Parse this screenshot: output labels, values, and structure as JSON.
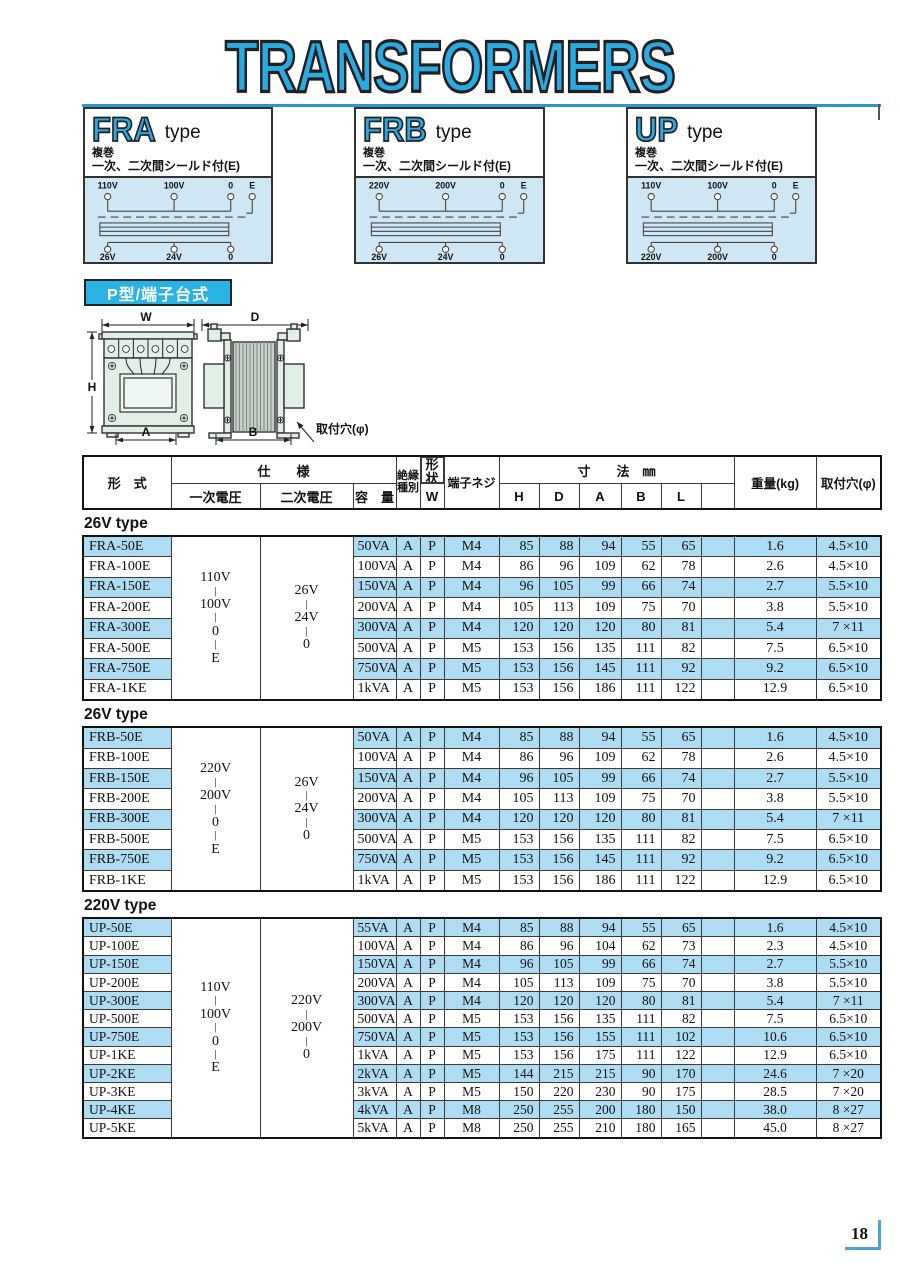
{
  "page": {
    "title": "TRANSFORMERS",
    "page_number": "18"
  },
  "colors": {
    "accent_blue": "#29abe2",
    "row_blue": "#aedcf2",
    "diagram_bg": "#cfe6f4",
    "badge_bg": "#29b2e5",
    "rule_blue": "#2b96d1",
    "corner_blue": "#4da3d8",
    "drawing_mint": "#e2efe6"
  },
  "type_boxes": [
    {
      "name": "FRA",
      "suffix": "type",
      "desc_line1": "複巻",
      "desc_line2": "一次、二次間シールド付(E)",
      "top_terminals": [
        "110V",
        "100V",
        "0",
        "E"
      ],
      "bottom_terminals": [
        "26V",
        "24V",
        "0"
      ]
    },
    {
      "name": "FRB",
      "suffix": "type",
      "desc_line1": "複巻",
      "desc_line2": "一次、二次間シールド付(E)",
      "top_terminals": [
        "220V",
        "200V",
        "0",
        "E"
      ],
      "bottom_terminals": [
        "26V",
        "24V",
        "0"
      ]
    },
    {
      "name": "UP",
      "suffix": "type",
      "desc_line1": "複巻",
      "desc_line2": "一次、二次間シールド付(E)",
      "top_terminals": [
        "110V",
        "100V",
        "0",
        "E"
      ],
      "bottom_terminals": [
        "220V",
        "200V",
        "0"
      ]
    }
  ],
  "shape_badge": "P型/端子台式",
  "dim": {
    "w": "W",
    "d": "D",
    "h": "H",
    "a": "A",
    "b": "B",
    "hole_label": "取付穴(φ)"
  },
  "table_header": {
    "model": "形　式",
    "spec": "仕　　様",
    "primary": "一次電圧",
    "secondary": "二次電圧",
    "capacity": "容　量",
    "insulation_l1": "絶縁",
    "insulation_l2": "種別",
    "shape": "形状",
    "screw": "端子ネジ",
    "dims": "寸　　法　㎜",
    "dim_cols": [
      "W",
      "H",
      "D",
      "A",
      "B",
      "L"
    ],
    "weight": "重量(kg)",
    "hole": "取付穴(φ)"
  },
  "sections": [
    {
      "title": "26V type",
      "primary": [
        "110V",
        "|",
        "100V",
        "|",
        "0",
        "|",
        "E"
      ],
      "secondary": [
        "26V",
        "|",
        "24V",
        "|",
        "0"
      ],
      "rows": [
        {
          "model": "FRA-50E",
          "cap": "50VA",
          "ins": "A",
          "shape": "P",
          "screw": "M4",
          "w": "85",
          "h": "88",
          "d": "94",
          "a": "55",
          "b": "65",
          "l": "",
          "kg": "1.6",
          "hole": "4.5×10"
        },
        {
          "model": "FRA-100E",
          "cap": "100VA",
          "ins": "A",
          "shape": "P",
          "screw": "M4",
          "w": "86",
          "h": "96",
          "d": "109",
          "a": "62",
          "b": "78",
          "l": "",
          "kg": "2.6",
          "hole": "4.5×10"
        },
        {
          "model": "FRA-150E",
          "cap": "150VA",
          "ins": "A",
          "shape": "P",
          "screw": "M4",
          "w": "96",
          "h": "105",
          "d": "99",
          "a": "66",
          "b": "74",
          "l": "",
          "kg": "2.7",
          "hole": "5.5×10"
        },
        {
          "model": "FRA-200E",
          "cap": "200VA",
          "ins": "A",
          "shape": "P",
          "screw": "M4",
          "w": "105",
          "h": "113",
          "d": "109",
          "a": "75",
          "b": "70",
          "l": "",
          "kg": "3.8",
          "hole": "5.5×10"
        },
        {
          "model": "FRA-300E",
          "cap": "300VA",
          "ins": "A",
          "shape": "P",
          "screw": "M4",
          "w": "120",
          "h": "120",
          "d": "120",
          "a": "80",
          "b": "81",
          "l": "",
          "kg": "5.4",
          "hole": "7 ×11"
        },
        {
          "model": "FRA-500E",
          "cap": "500VA",
          "ins": "A",
          "shape": "P",
          "screw": "M5",
          "w": "153",
          "h": "156",
          "d": "135",
          "a": "111",
          "b": "82",
          "l": "",
          "kg": "7.5",
          "hole": "6.5×10"
        },
        {
          "model": "FRA-750E",
          "cap": "750VA",
          "ins": "A",
          "shape": "P",
          "screw": "M5",
          "w": "153",
          "h": "156",
          "d": "145",
          "a": "111",
          "b": "92",
          "l": "",
          "kg": "9.2",
          "hole": "6.5×10"
        },
        {
          "model": "FRA-1KE",
          "cap": "1kVA",
          "ins": "A",
          "shape": "P",
          "screw": "M5",
          "w": "153",
          "h": "156",
          "d": "186",
          "a": "111",
          "b": "122",
          "l": "",
          "kg": "12.9",
          "hole": "6.5×10"
        }
      ]
    },
    {
      "title": "26V type",
      "primary": [
        "220V",
        "|",
        "200V",
        "|",
        "0",
        "|",
        "E"
      ],
      "secondary": [
        "26V",
        "|",
        "24V",
        "|",
        "0"
      ],
      "rows": [
        {
          "model": "FRB-50E",
          "cap": "50VA",
          "ins": "A",
          "shape": "P",
          "screw": "M4",
          "w": "85",
          "h": "88",
          "d": "94",
          "a": "55",
          "b": "65",
          "l": "",
          "kg": "1.6",
          "hole": "4.5×10"
        },
        {
          "model": "FRB-100E",
          "cap": "100VA",
          "ins": "A",
          "shape": "P",
          "screw": "M4",
          "w": "86",
          "h": "96",
          "d": "109",
          "a": "62",
          "b": "78",
          "l": "",
          "kg": "2.6",
          "hole": "4.5×10"
        },
        {
          "model": "FRB-150E",
          "cap": "150VA",
          "ins": "A",
          "shape": "P",
          "screw": "M4",
          "w": "96",
          "h": "105",
          "d": "99",
          "a": "66",
          "b": "74",
          "l": "",
          "kg": "2.7",
          "hole": "5.5×10"
        },
        {
          "model": "FRB-200E",
          "cap": "200VA",
          "ins": "A",
          "shape": "P",
          "screw": "M4",
          "w": "105",
          "h": "113",
          "d": "109",
          "a": "75",
          "b": "70",
          "l": "",
          "kg": "3.8",
          "hole": "5.5×10"
        },
        {
          "model": "FRB-300E",
          "cap": "300VA",
          "ins": "A",
          "shape": "P",
          "screw": "M4",
          "w": "120",
          "h": "120",
          "d": "120",
          "a": "80",
          "b": "81",
          "l": "",
          "kg": "5.4",
          "hole": "7 ×11"
        },
        {
          "model": "FRB-500E",
          "cap": "500VA",
          "ins": "A",
          "shape": "P",
          "screw": "M5",
          "w": "153",
          "h": "156",
          "d": "135",
          "a": "111",
          "b": "82",
          "l": "",
          "kg": "7.5",
          "hole": "6.5×10"
        },
        {
          "model": "FRB-750E",
          "cap": "750VA",
          "ins": "A",
          "shape": "P",
          "screw": "M5",
          "w": "153",
          "h": "156",
          "d": "145",
          "a": "111",
          "b": "92",
          "l": "",
          "kg": "9.2",
          "hole": "6.5×10"
        },
        {
          "model": "FRB-1KE",
          "cap": "1kVA",
          "ins": "A",
          "shape": "P",
          "screw": "M5",
          "w": "153",
          "h": "156",
          "d": "186",
          "a": "111",
          "b": "122",
          "l": "",
          "kg": "12.9",
          "hole": "6.5×10"
        }
      ]
    },
    {
      "title": "220V type",
      "primary": [
        "110V",
        "|",
        "100V",
        "|",
        "0",
        "|",
        "E"
      ],
      "secondary": [
        "220V",
        "|",
        "200V",
        "|",
        "0"
      ],
      "rows": [
        {
          "model": "UP-50E",
          "cap": "55VA",
          "ins": "A",
          "shape": "P",
          "screw": "M4",
          "w": "85",
          "h": "88",
          "d": "94",
          "a": "55",
          "b": "65",
          "l": "",
          "kg": "1.6",
          "hole": "4.5×10"
        },
        {
          "model": "UP-100E",
          "cap": "100VA",
          "ins": "A",
          "shape": "P",
          "screw": "M4",
          "w": "86",
          "h": "96",
          "d": "104",
          "a": "62",
          "b": "73",
          "l": "",
          "kg": "2.3",
          "hole": "4.5×10"
        },
        {
          "model": "UP-150E",
          "cap": "150VA",
          "ins": "A",
          "shape": "P",
          "screw": "M4",
          "w": "96",
          "h": "105",
          "d": "99",
          "a": "66",
          "b": "74",
          "l": "",
          "kg": "2.7",
          "hole": "5.5×10"
        },
        {
          "model": "UP-200E",
          "cap": "200VA",
          "ins": "A",
          "shape": "P",
          "screw": "M4",
          "w": "105",
          "h": "113",
          "d": "109",
          "a": "75",
          "b": "70",
          "l": "",
          "kg": "3.8",
          "hole": "5.5×10"
        },
        {
          "model": "UP-300E",
          "cap": "300VA",
          "ins": "A",
          "shape": "P",
          "screw": "M4",
          "w": "120",
          "h": "120",
          "d": "120",
          "a": "80",
          "b": "81",
          "l": "",
          "kg": "5.4",
          "hole": "7 ×11"
        },
        {
          "model": "UP-500E",
          "cap": "500VA",
          "ins": "A",
          "shape": "P",
          "screw": "M5",
          "w": "153",
          "h": "156",
          "d": "135",
          "a": "111",
          "b": "82",
          "l": "",
          "kg": "7.5",
          "hole": "6.5×10"
        },
        {
          "model": "UP-750E",
          "cap": "750VA",
          "ins": "A",
          "shape": "P",
          "screw": "M5",
          "w": "153",
          "h": "156",
          "d": "155",
          "a": "111",
          "b": "102",
          "l": "",
          "kg": "10.6",
          "hole": "6.5×10"
        },
        {
          "model": "UP-1KE",
          "cap": "1kVA",
          "ins": "A",
          "shape": "P",
          "screw": "M5",
          "w": "153",
          "h": "156",
          "d": "175",
          "a": "111",
          "b": "122",
          "l": "",
          "kg": "12.9",
          "hole": "6.5×10"
        },
        {
          "model": "UP-2KE",
          "cap": "2kVA",
          "ins": "A",
          "shape": "P",
          "screw": "M5",
          "w": "144",
          "h": "215",
          "d": "215",
          "a": "90",
          "b": "170",
          "l": "",
          "kg": "24.6",
          "hole": "7 ×20"
        },
        {
          "model": "UP-3KE",
          "cap": "3kVA",
          "ins": "A",
          "shape": "P",
          "screw": "M5",
          "w": "150",
          "h": "220",
          "d": "230",
          "a": "90",
          "b": "175",
          "l": "",
          "kg": "28.5",
          "hole": "7 ×20"
        },
        {
          "model": "UP-4KE",
          "cap": "4kVA",
          "ins": "A",
          "shape": "P",
          "screw": "M8",
          "w": "250",
          "h": "255",
          "d": "200",
          "a": "180",
          "b": "150",
          "l": "",
          "kg": "38.0",
          "hole": "8 ×27"
        },
        {
          "model": "UP-5KE",
          "cap": "5kVA",
          "ins": "A",
          "shape": "P",
          "screw": "M8",
          "w": "250",
          "h": "255",
          "d": "210",
          "a": "180",
          "b": "165",
          "l": "",
          "kg": "45.0",
          "hole": "8 ×27"
        }
      ]
    }
  ]
}
